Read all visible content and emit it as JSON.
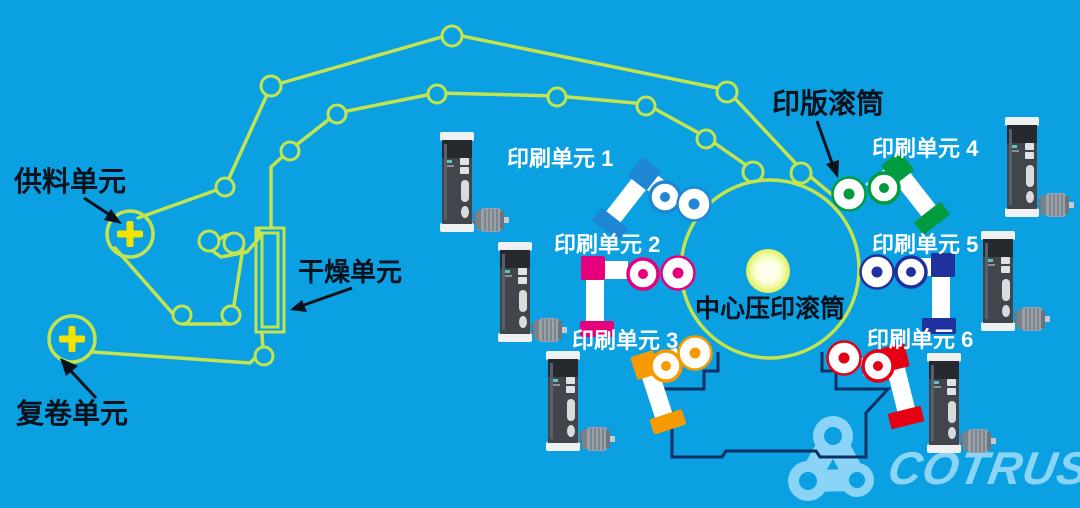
{
  "colors": {
    "background": "#0aa0e2",
    "web": "#c3e44e",
    "plus": "#f2e400",
    "frame": "#0e2f63",
    "logo": "#8ad5f7",
    "white": "#ffffff",
    "black": "#07121c"
  },
  "labels": {
    "feed_unit": "供料单元",
    "rewind_unit": "复卷单元",
    "drying_unit": "干燥单元",
    "plate_cylinder": "印版滚筒",
    "central_impression_cylinder": "中心压印滚筒"
  },
  "print_units": [
    {
      "label": "印刷单元 1",
      "color": "#1e86d2"
    },
    {
      "label": "印刷单元 2",
      "color": "#e6007e"
    },
    {
      "label": "印刷单元 3",
      "color": "#f59b00"
    },
    {
      "label": "印刷单元 4",
      "color": "#009b3e"
    },
    {
      "label": "印刷单元 5",
      "color": "#20309e"
    },
    {
      "label": "印刷单元 6",
      "color": "#e60013"
    }
  ],
  "logo": {
    "text": "COTRUST"
  }
}
